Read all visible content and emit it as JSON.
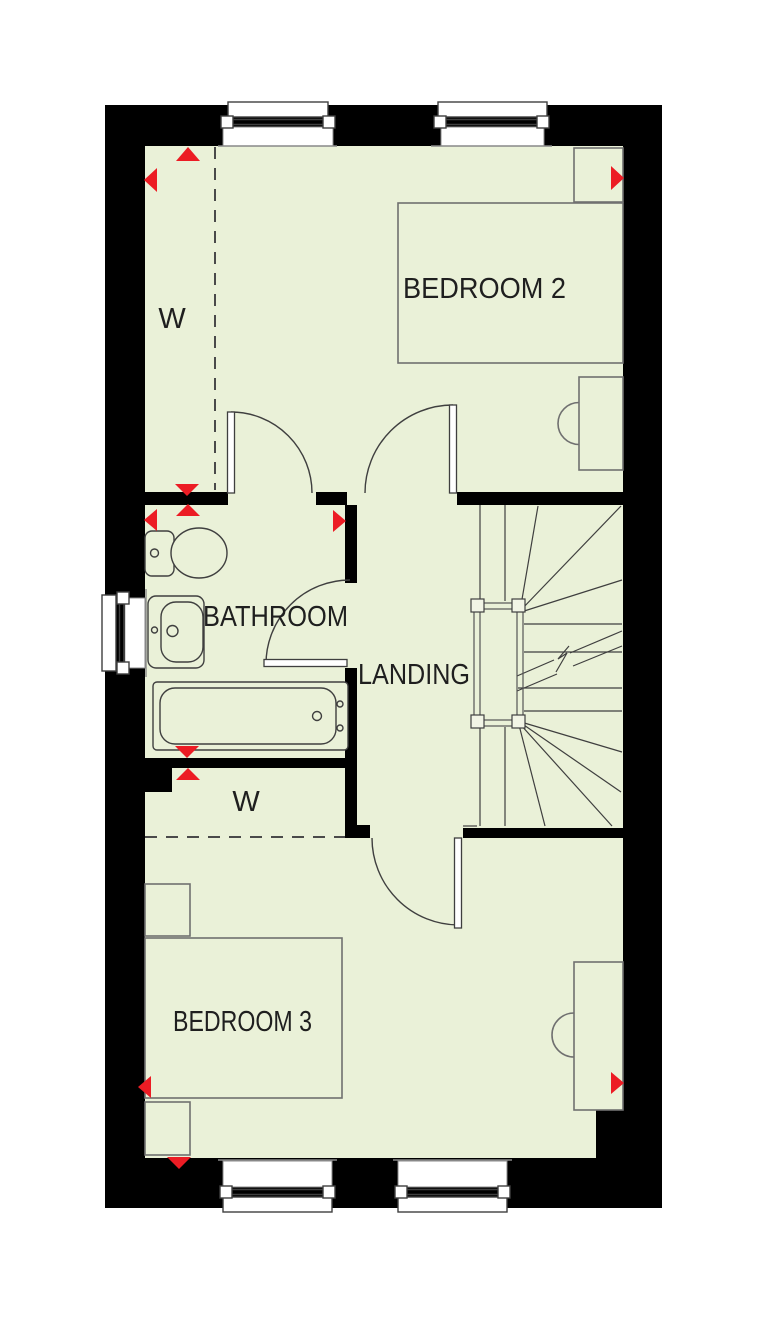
{
  "floorplan": {
    "title": "First floor plan",
    "rooms": {
      "bedroom2": {
        "label": "BEDROOM 2"
      },
      "bathroom": {
        "label": "BATHROOM"
      },
      "landing": {
        "label": "LANDING"
      },
      "bedroom3": {
        "label": "BEDROOM 3"
      },
      "wardrobe_top": {
        "label": "W"
      },
      "wardrobe_lower": {
        "label": "W"
      }
    },
    "colors": {
      "floor": "#EAF1D8",
      "wall": "#000000",
      "marker_red": "#EC1C24",
      "fixture_line": "#3f3f3f",
      "furniture_line": "#707070",
      "sill_line": "#888888",
      "text": "#1f1f1f"
    }
  }
}
